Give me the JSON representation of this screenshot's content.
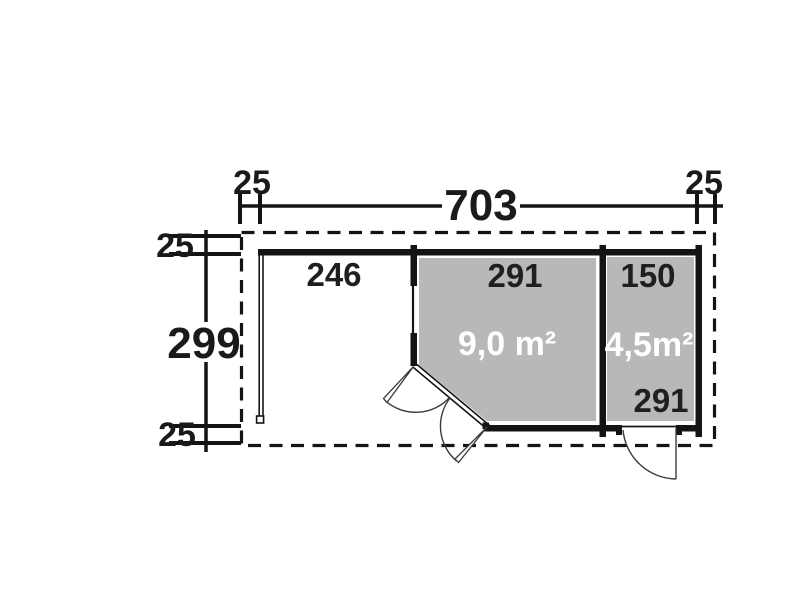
{
  "plan": {
    "type": "garden-house floor plan",
    "dim_top": {
      "left_offset": "25",
      "width": "703",
      "right_offset": "25"
    },
    "dim_left": {
      "top_offset": "25",
      "height": "299",
      "bottom_offset": "25"
    },
    "porch": {
      "width": "246"
    },
    "room_main": {
      "width": "291",
      "area": "9,0 m²"
    },
    "room_side": {
      "width": "150",
      "area": "4,5m²",
      "depth": "291"
    },
    "colors": {
      "line": "#141414",
      "room_fill": "#b8b8b8",
      "area_text": "#ffffff",
      "background": "#ffffff"
    }
  }
}
